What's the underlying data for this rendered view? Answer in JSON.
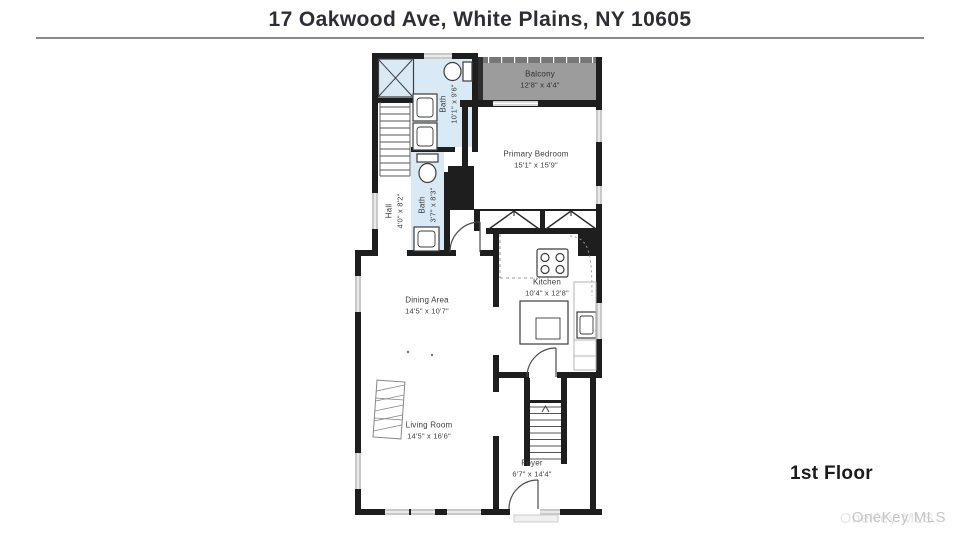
{
  "header": {
    "title": "17 Oakwood Ave, White Plains, NY 10605"
  },
  "floor_label": "1st Floor",
  "watermark": "OneKey MLS",
  "colors": {
    "wall": "#1e1e1e",
    "bath_fill": "#d9e9f6",
    "balcony_fill": "#9c9c9c",
    "window": "#c8c8c8",
    "label_text": "#3d3d3d",
    "title_text": "#2d2d35",
    "divider_rule": "#8a8a8a",
    "watermark_text": "#c6c6c6"
  },
  "rooms": [
    {
      "id": "balcony",
      "name": "Balcony",
      "dims": "12'8\" x 4'4\""
    },
    {
      "id": "primary-bedroom",
      "name": "Primary Bedroom",
      "dims": "15'1\" x 15'9\""
    },
    {
      "id": "bath-upper",
      "name": "Bath",
      "dims": "10'1\" x 9'6\""
    },
    {
      "id": "bath-hall",
      "name": "Bath",
      "dims": "3'7\" x 8'3\""
    },
    {
      "id": "hall",
      "name": "Hall",
      "dims": "4'0\" x 8'2\""
    },
    {
      "id": "dining-area",
      "name": "Dining Area",
      "dims": "14'5\" x 10'7\""
    },
    {
      "id": "kitchen",
      "name": "Kitchen",
      "dims": "10'4\" x 12'8\""
    },
    {
      "id": "living-room",
      "name": "Living Room",
      "dims": "14'5\" x 16'6\""
    },
    {
      "id": "foyer",
      "name": "Foyer",
      "dims": "6'7\" x 14'4\""
    }
  ]
}
